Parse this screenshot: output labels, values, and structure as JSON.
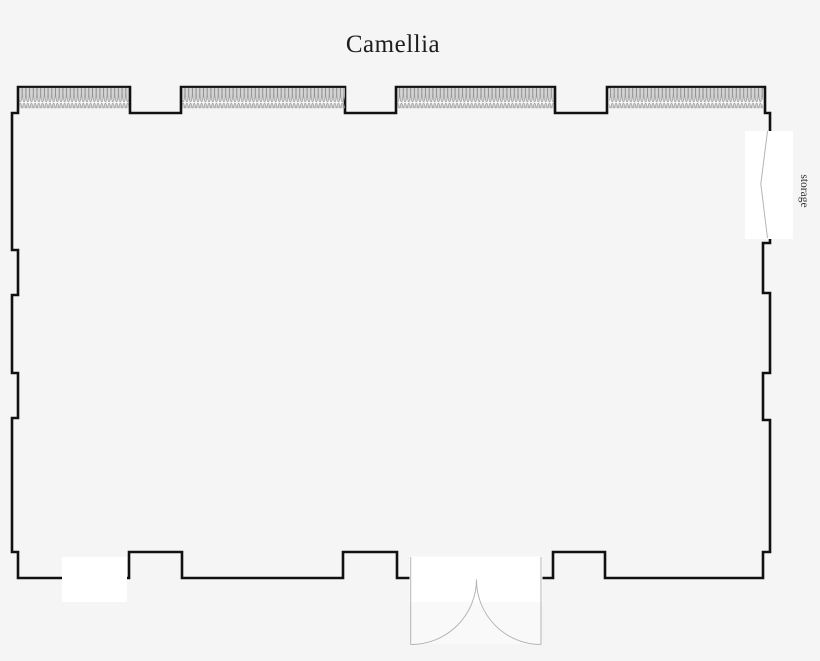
{
  "page": {
    "background_color": "#f5f5f5"
  },
  "floorplan": {
    "title": "Camellia",
    "labels": {
      "storage": "storage"
    },
    "colors": {
      "wall": "#111111",
      "partition_fill": "#d3d3d3",
      "partition_stroke": "#8e8e8e",
      "door_line": "#b5b5b5",
      "opening_fill": "#ffffff",
      "below_door_fill": "#f9f9f9"
    },
    "features": {
      "operable_wall_section_count": 4,
      "door_opening_count": 3
    }
  }
}
